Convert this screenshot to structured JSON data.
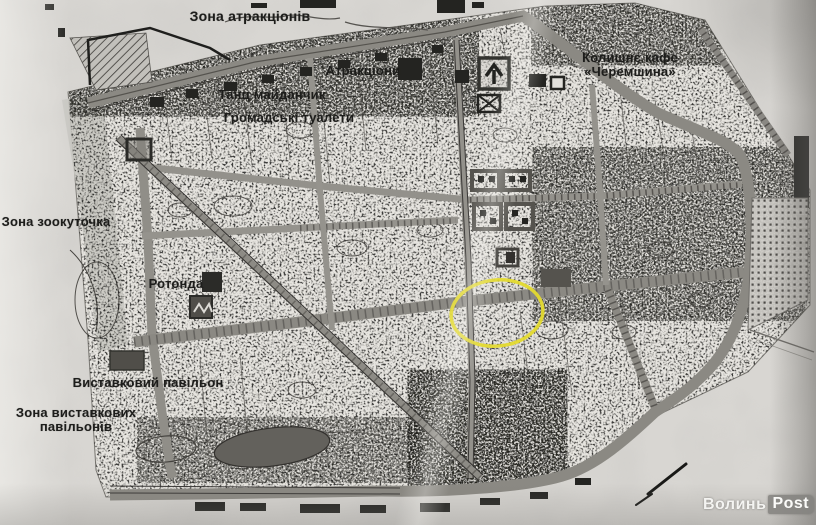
{
  "page": {
    "type": "scanned park plan",
    "description": "Black-and-white scanned map of a city park with Ukrainian zone labels and a yellow ellipse highlighting a central area"
  },
  "map": {
    "labels": {
      "zone_attractions": {
        "text": "Зона атракціонів"
      },
      "attractions": {
        "text": "Атракціони"
      },
      "dance_floor": {
        "text": "Танц майданчик"
      },
      "public_toilets": {
        "text": "Громадські туалети"
      },
      "former_cafe": {
        "text": "Колишнє кафе «Черемшина»"
      },
      "zoo_zone": {
        "text": "Зона зоокуточка"
      },
      "rotunda": {
        "text": "Ротонда"
      },
      "exhibition_pavilion": {
        "text": "Виставковий павільон"
      },
      "exhibition_zone": {
        "text": "Зона виставкових\nпавільонів"
      }
    },
    "annotation": {
      "shape": "ellipse",
      "purpose": "highlighted area on map",
      "color": "#e4da2f",
      "cx": 497,
      "cy": 313,
      "rx": 46,
      "ry": 33,
      "rotation_deg": -6
    },
    "watermark": {
      "part1": "Волинь",
      "part2": "Post"
    },
    "colors": {
      "paper": "#d8d6d2",
      "map_background": "#e6e4df",
      "road_gray": "#8f8d87",
      "ink_dark": "#22221f",
      "zoo_strip": "#c8c6c1",
      "pond_dark": "#63615c",
      "highlight_yellow": "#e4da2f",
      "watermark_badge": "#82817e"
    }
  }
}
